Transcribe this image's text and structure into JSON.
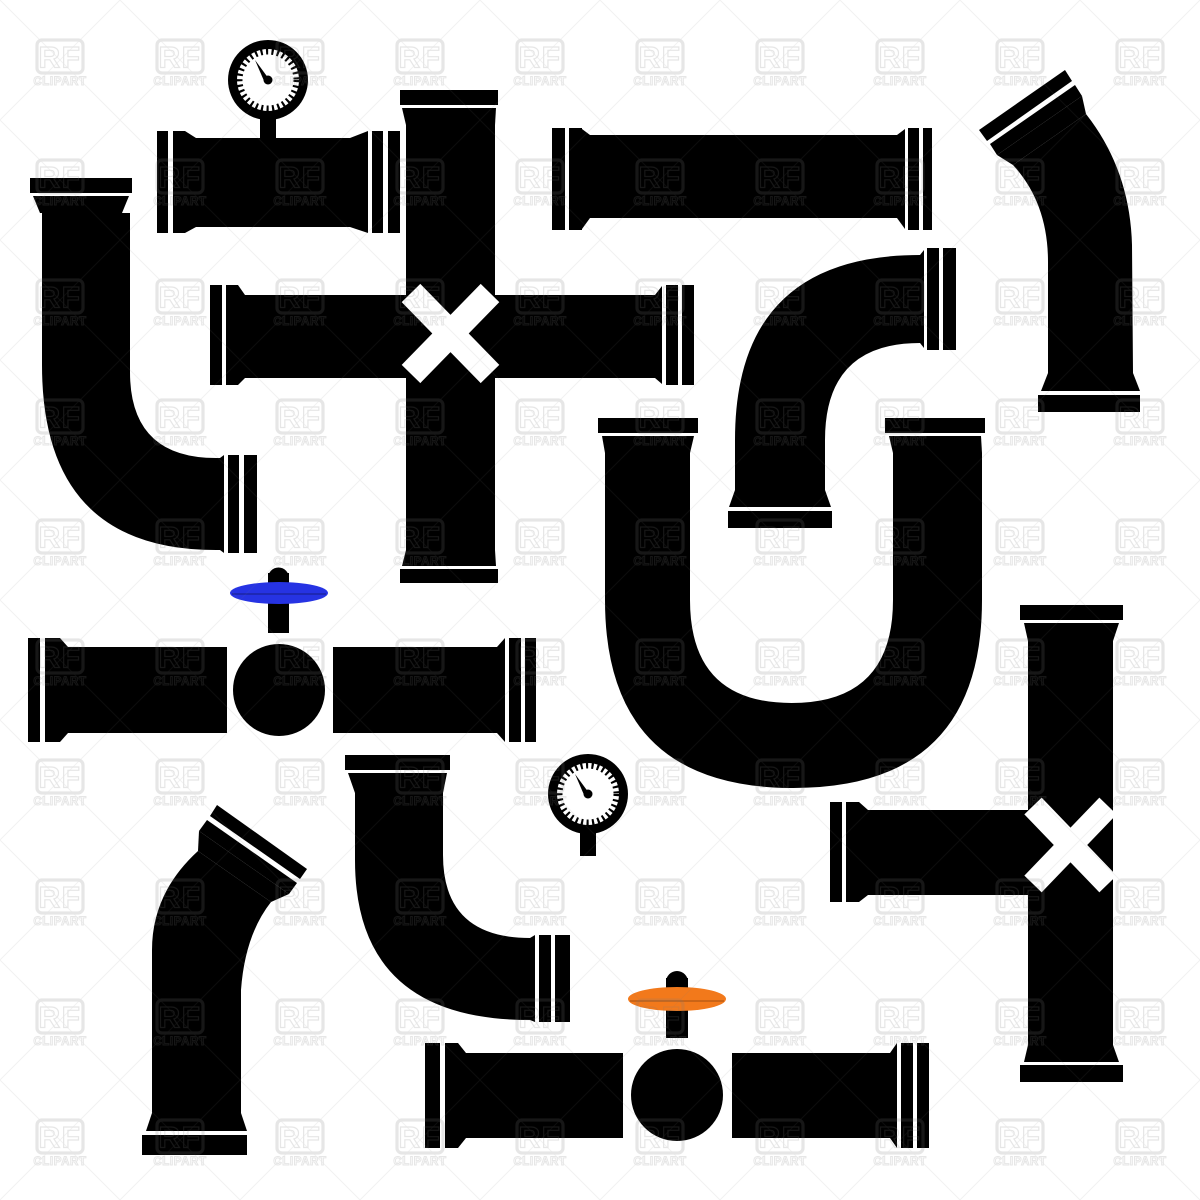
{
  "canvas": {
    "width": 1200,
    "height": 1200,
    "background": "#ffffff"
  },
  "palette": {
    "pipe_black": "#000000",
    "gauge_face": "#ffffff",
    "valve_handle_blue": "#2633e3",
    "valve_handle_orange": "#f2791b",
    "watermark_gray": "#7a7a7a",
    "cross_marker_white": "#ffffff"
  },
  "watermark": {
    "line1": "RF",
    "line2": "CLIPART",
    "tile_size": 120,
    "opacity": 0.19
  },
  "pieces": [
    {
      "name": "pipe-gauge-top-left",
      "description": "straight flanged pipe with pressure gauge on top",
      "color": "#000000"
    },
    {
      "name": "elbow-top-left",
      "description": "90-degree elbow, down then right",
      "color": "#000000"
    },
    {
      "name": "cross-pipe-vertical",
      "description": "long vertical pipe with white X cross marker",
      "color": "#000000"
    },
    {
      "name": "pipe-horizontal-middle",
      "description": "horizontal flanged pipe crossing vertical pipe",
      "color": "#000000"
    },
    {
      "name": "pipe-horizontal-top",
      "description": "straight horizontal flanged pipe",
      "color": "#000000"
    },
    {
      "name": "elbow-right-n",
      "description": "90-degree elbow, right opening to bottom opening",
      "color": "#000000"
    },
    {
      "name": "pipe-angled-top-right",
      "description": "bent pipe with slanted top flange",
      "color": "#000000"
    },
    {
      "name": "pipe-u-shape",
      "description": "large U-bend pipe with two top flanges",
      "color": "#000000"
    },
    {
      "name": "pipe-valve-blue",
      "description": "horizontal pipe with ball valve and blue handle",
      "color": "#000000",
      "accent": "#2633e3"
    },
    {
      "name": "pipe-angled-bottom-left",
      "description": "bent pipe with slanted top flange",
      "color": "#000000"
    },
    {
      "name": "elbow-bottom-middle",
      "description": "90-degree elbow, down then right",
      "color": "#000000"
    },
    {
      "name": "gauge-bottom",
      "description": "standalone pressure gauge",
      "color": "#000000"
    },
    {
      "name": "pipe-valve-orange",
      "description": "horizontal pipe with ball valve and orange handle",
      "color": "#000000",
      "accent": "#f2791b"
    },
    {
      "name": "pipe-vertical-right-x",
      "description": "vertical pipe with white X cross marker",
      "color": "#000000"
    },
    {
      "name": "pipe-stub-right",
      "description": "short horizontal stub pipe joining vertical pipe",
      "color": "#000000"
    }
  ]
}
